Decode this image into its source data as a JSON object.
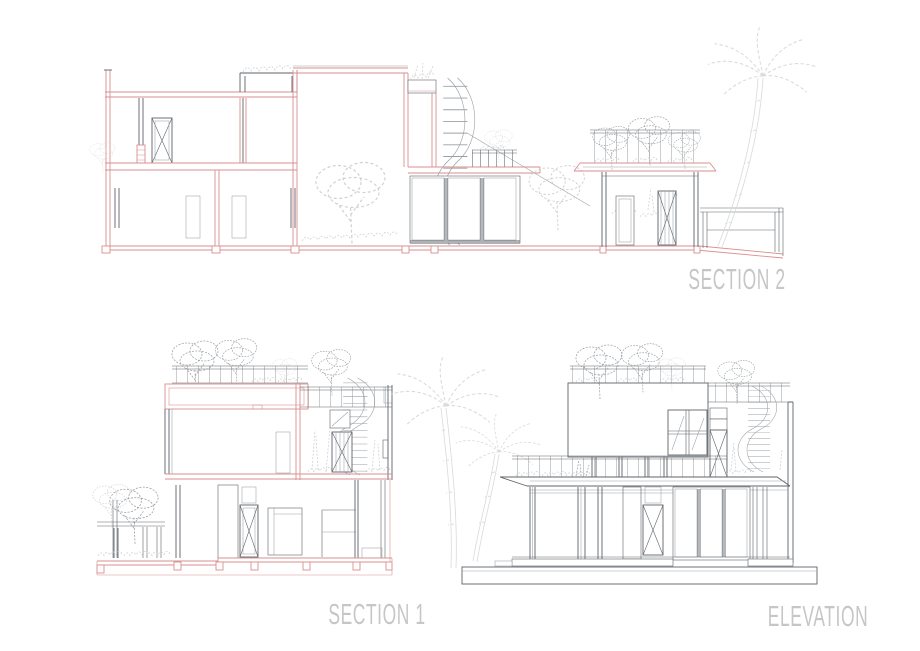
{
  "sheet": {
    "description": "Architectural drawing sheet with two building sections and one elevation"
  },
  "drawings": [
    {
      "id": "section-2",
      "label": "SECTION 2"
    },
    {
      "id": "section-1",
      "label": "SECTION 1"
    },
    {
      "id": "elevation",
      "label": "ELEVATION"
    }
  ],
  "colors": {
    "page-bg": "#ffffff",
    "cut-red": "#db8f8f",
    "ink": "#5f646a",
    "ink-light": "#9aa0a5",
    "foliage-light": "#cfd2d4",
    "foliage-medium": "#9ca1a5",
    "palm": "#d7dadc",
    "label": "#c6c6c6",
    "glass-hatch": "#b9bdc0",
    "texture-dot": "#c6cacd",
    "texture-dot-dark": "#b3b8bb"
  }
}
